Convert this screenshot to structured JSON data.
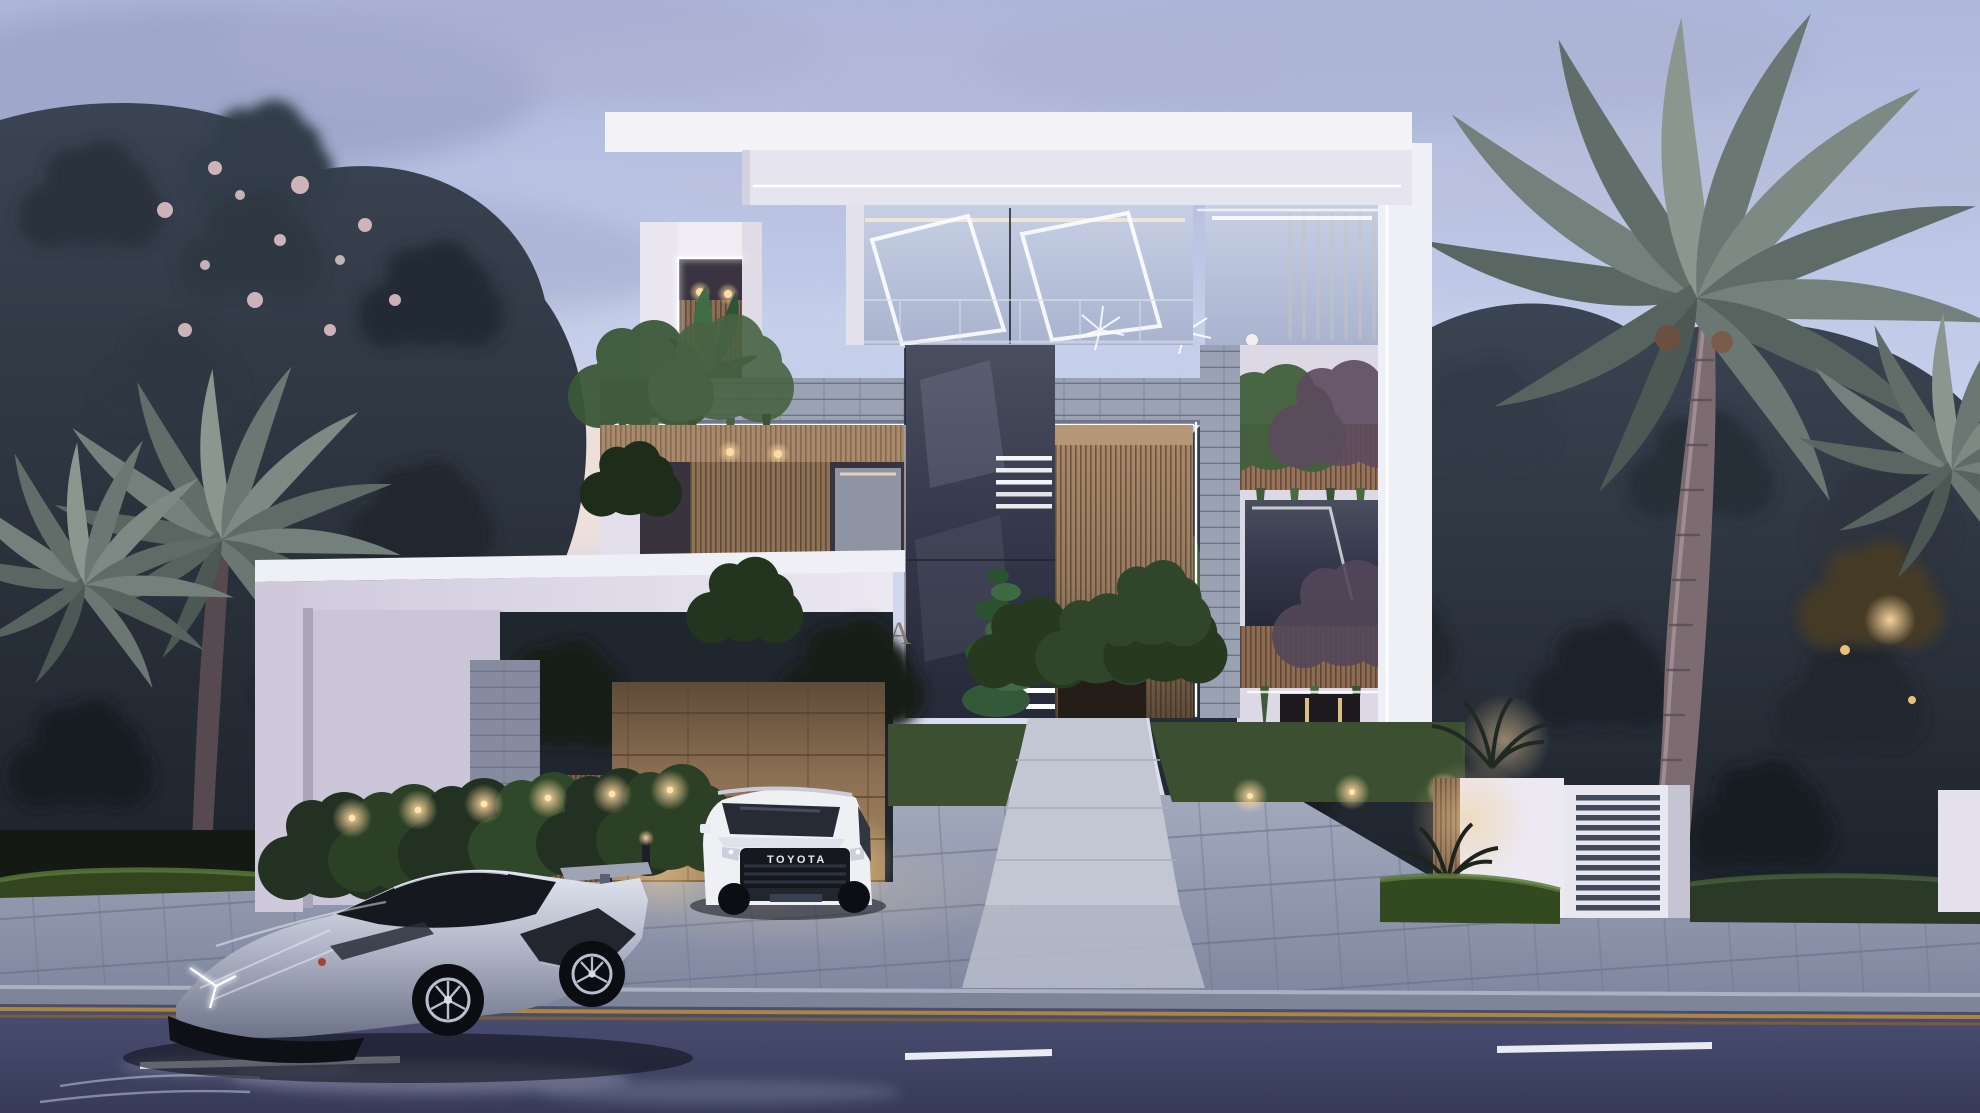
{
  "image": {
    "kind": "3D architectural exterior rendering",
    "time_of_day": "dusk",
    "description": "Three-storey modern white villa with timber and stone accents and LED strip lighting; landscaped front yard with hedges and uplights; a silver supercar parked at the curb and a white SUV in the driveway; palm trees and dense dark trees behind; two-lane asphalt road in the foreground."
  },
  "villa": {
    "sign": {
      "text": "OHANA",
      "color": "#8b8075",
      "location": "white gate-canopy fascia"
    },
    "materials": [
      "white render",
      "timber slats",
      "grey ledger stone",
      "tan stone feature wall",
      "glass"
    ],
    "lighting": [
      "white LED edge strips",
      "warm garden uplights",
      "recessed soffit downlights",
      "illuminated stair treads"
    ],
    "occupant": "person in a white robe behind the upper-floor glass"
  },
  "vehicles": {
    "suv": {
      "type": "white SUV, front view",
      "badge": "TOYOTA"
    },
    "supercar": {
      "type": "silver wedge-shaped supercar parked on the road"
    }
  },
  "landscape": [
    "tall palm tree on the right",
    "flowering tree on the left",
    "clipped hedges with uplights",
    "spiral topiary by the entrance",
    "banana plant on the roof terrace"
  ],
  "street": {
    "sidewalk": "grey stone pavers",
    "center_line_color": "#b5873b",
    "lane_dash_color": "#e8ebf2",
    "asphalt_color": "#3f4466"
  },
  "sky": {
    "top": "#aeb7dc",
    "horizon": "#eee4e3",
    "clouds": "lavender-grey"
  },
  "palette": {
    "facade_white": "#efedf4",
    "wood": "#9c8166",
    "stone_band": "#99a1b3",
    "gate_stone": "#8a6e52",
    "foliage_dark": "#273039",
    "led": "#ffffff",
    "uplight": "#eec98a"
  }
}
